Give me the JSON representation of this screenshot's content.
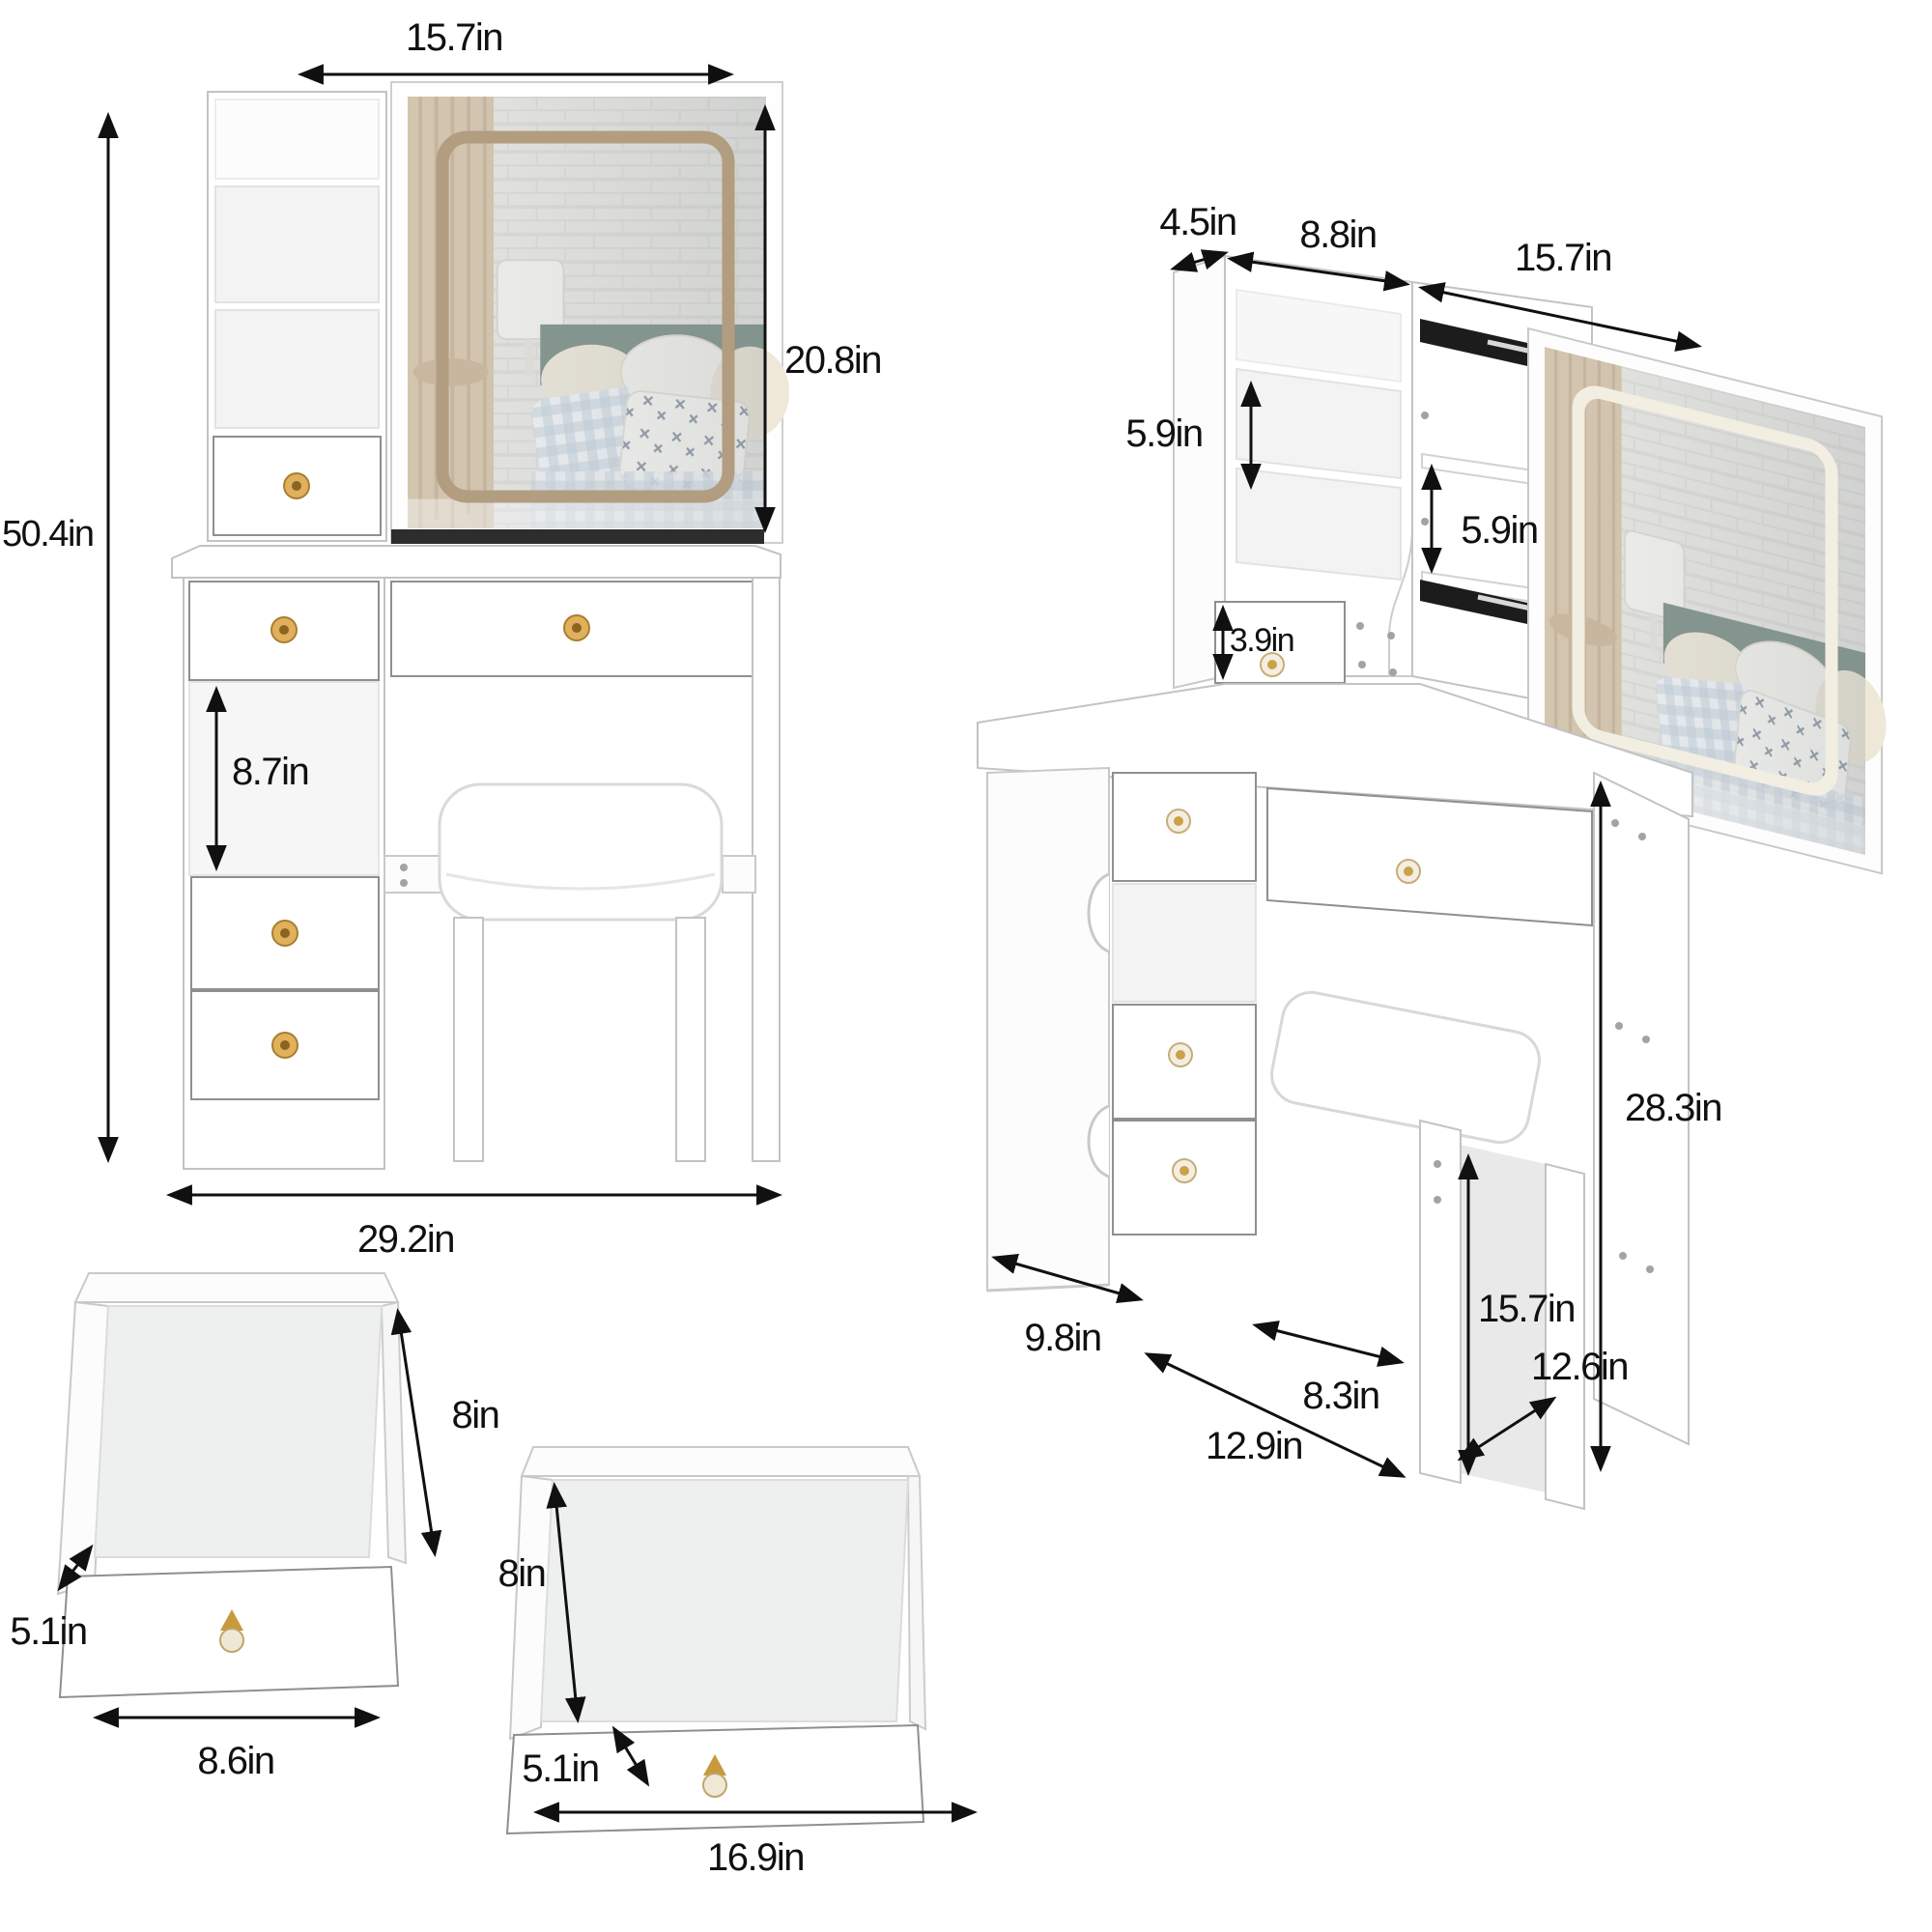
{
  "front_view": {
    "mirror_width": "15.7in",
    "mirror_height": "20.8in",
    "total_height": "50.4in",
    "shelf_gap_height": "8.7in",
    "base_width": "29.2in"
  },
  "angled_view": {
    "hutch_depth": "4.5in",
    "hutch_width": "8.8in",
    "mirror_width": "15.7in",
    "left_shelf_height": "5.9in",
    "middle_shelf_height": "5.9in",
    "small_drawer_height": "3.9in",
    "table_height": "28.3in",
    "cabinet_depth": "9.8in",
    "knee_space_width": "8.3in",
    "stool_height": "15.7in",
    "table_width": "12.9in",
    "side_panel_depth": "12.6in"
  },
  "small_drawer": {
    "depth": "8in",
    "height": "5.1in",
    "width": "8.6in"
  },
  "large_drawer": {
    "depth": "8in",
    "height": "5.1in",
    "width": "16.9in"
  }
}
